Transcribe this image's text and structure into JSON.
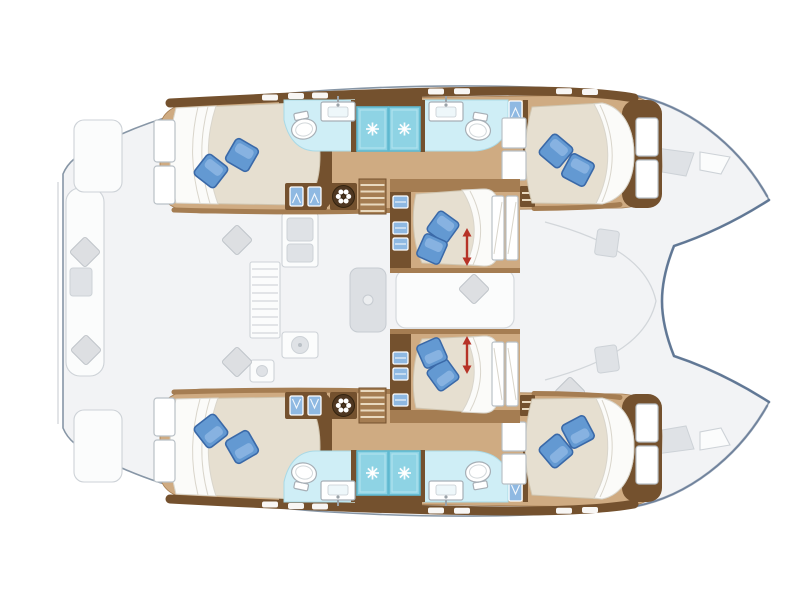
{
  "meta": {
    "title": "Catamaran yacht deck and cabin layout floor plan, top-down view, bow pointing right",
    "image_type": "boat floor plan illustration",
    "background": "#ffffff"
  },
  "colors": {
    "hull_outline": "#5c7392",
    "outline_gray": "#8796a6",
    "deck_ghost_fill": "#f2f3f5",
    "ghost_light": "#fbfcfc",
    "ghost_dark": "#dfe2e6",
    "ghost_stroke": "#cdd2d7",
    "ghost_line": "#d2d6da",
    "cushion_gray": "#dddfe2",
    "wood_floor": "#cfab82",
    "wood_mid": "#a57d52",
    "wood_dark": "#74512e",
    "step_light": "#e9d9bf",
    "bed_cream": "#e6dfd0",
    "bed_edge": "#cfc5b0",
    "sheet_white": "#fbfbf9",
    "fold_gray": "#d9d5cb",
    "pillow_main": "#6399d2",
    "pillow_dark": "#3a69a8",
    "pillow_light": "#93bbe6",
    "shower_cyan": "#8ed3e4",
    "shower_border": "#5fb9d0",
    "bath_counter": "#cfeef6",
    "hatch_blue": "#8fb9e2",
    "arrow_red": "#b63327",
    "wheel_brown": "#4f3721",
    "fixture_stroke": "#a7afb6"
  },
  "layout": {
    "orientation": "bow right, stern left",
    "hulls": [
      {
        "id": "port-hull",
        "position": "top",
        "rooms": [
          "aft double cabin",
          "aft bathroom with shower",
          "forward bathroom with shower",
          "forward double cabin"
        ]
      },
      {
        "id": "starboard-hull",
        "position": "bottom",
        "rooms": [
          "aft double cabin",
          "aft bathroom with shower",
          "forward bathroom with shower",
          "forward double cabin"
        ]
      }
    ],
    "center": {
      "rooms": [
        "center cabin top with convertible double berth",
        "salon seating with table",
        "center cabin bottom with convertible double berth"
      ],
      "galley": "amidships, port side of salon"
    },
    "deck_ghosted": [
      "aft cockpit bench with cushions",
      "cockpit corner loungers",
      "foredeck locker hatches",
      "bow tips",
      "transom steps"
    ]
  },
  "counts": {
    "cabins": 6,
    "double_beds": 6,
    "blue_bed_pillows": 12,
    "showers": 4,
    "toilets": 4,
    "bathroom_sinks": 4,
    "convertible_bed_arrows": 2,
    "hull_staircases": 2,
    "round_drum_units": 2
  },
  "icons": {
    "shower_head": "white sparkle starburst on cyan shower pan",
    "drum_unit": "dark round drum with six white petals (wheel-icon)",
    "cabinet_door": "light blue door panel with white chevron",
    "convertible_bed": "red vertical double-headed arrow",
    "hull_window": "white slot in dark hull-side strip",
    "deck_cushion": "gray rotated square cushion",
    "bed_pillow": "blue rotated square pillow"
  }
}
